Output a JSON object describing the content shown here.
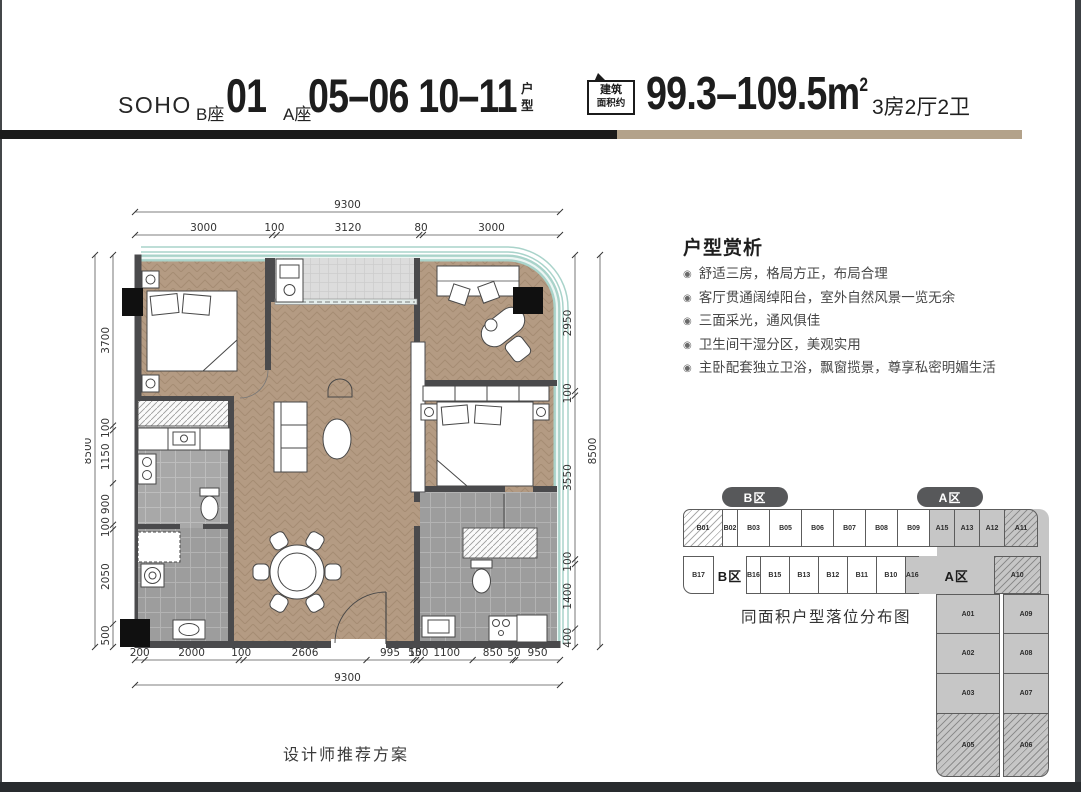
{
  "header": {
    "brand": "SOHO",
    "block_b": "B座",
    "unit_b": "01",
    "block_a": "A座",
    "units_a": "05–06 10–11",
    "suffix_top": "户",
    "suffix_bottom": "型",
    "badge_line1": "建筑",
    "badge_line2": "面积约",
    "area_value": "99.3–109.5m",
    "area_sup": "2",
    "rooms_spec": "3房2厅2卫"
  },
  "colors": {
    "divider_black": "#1b1b1b",
    "divider_tan": "#b3a28a",
    "floor_tan": "#b49b83",
    "glass_teal": "#a9d3ca",
    "wall_dark": "#4a4a4c",
    "zone_gray": "#c6c6c6"
  },
  "floorplan": {
    "dims": {
      "top_overall": "9300",
      "top_segments": [
        "3000",
        "100",
        "3120",
        "80",
        "3000"
      ],
      "left_overall": "8500",
      "left_segments": [
        "3700",
        "100",
        "1150",
        "900",
        "100",
        "2050",
        "500"
      ],
      "right_overall": "8500",
      "right_segments": [
        "2950",
        "100",
        "3550",
        "100",
        "1400",
        "400"
      ],
      "bottom_overall": "9300",
      "bottom_segments": [
        "200",
        "2000",
        "100",
        "2606",
        "995",
        "55",
        "100",
        "1100",
        "850",
        "50",
        "950"
      ]
    },
    "caption": "设计师推荐方案"
  },
  "analysis": {
    "title": "户型赏析",
    "bullet_glyph": "◉",
    "bullets": [
      "舒适三房，格局方正，布局合理",
      "客厅贯通阔绰阳台，室外自然风景一览无余",
      "三面采光，通风俱佳",
      "卫生间干湿分区，美观实用",
      "主卧配套独立卫浴，飘窗揽景，尊享私密明媚生活"
    ]
  },
  "locator": {
    "zone_b": "B区",
    "zone_a": "A区",
    "caption": "同面积户型落位分布图",
    "row1": [
      {
        "id": "B01",
        "zone": "b",
        "w": 40,
        "hatched": true,
        "r": "tl"
      },
      {
        "id": "B02",
        "zone": "b",
        "w": 16
      },
      {
        "id": "B03",
        "zone": "b",
        "w": 33
      },
      {
        "id": "B05",
        "zone": "b",
        "w": 33
      },
      {
        "id": "B06",
        "zone": "b",
        "w": 33
      },
      {
        "id": "B07",
        "zone": "b",
        "w": 33
      },
      {
        "id": "B08",
        "zone": "b",
        "w": 33
      },
      {
        "id": "B09",
        "zone": "b",
        "w": 33
      },
      {
        "id": "A15",
        "zone": "a",
        "w": 26
      },
      {
        "id": "A13",
        "zone": "a",
        "w": 26
      },
      {
        "id": "A12",
        "zone": "a",
        "w": 26
      },
      {
        "id": "A11",
        "zone": "a",
        "w": 34,
        "hatched": true,
        "r": "tr"
      }
    ],
    "row2": [
      {
        "id": "B17",
        "zone": "b",
        "w": 31,
        "r": "bl"
      },
      {
        "label": "B区",
        "zone": "label-b",
        "w": 34
      },
      {
        "id": "B16",
        "zone": "b",
        "w": 13
      },
      {
        "id": "B15",
        "zone": "b",
        "w": 30
      },
      {
        "id": "B13",
        "zone": "b",
        "w": 30
      },
      {
        "id": "B12",
        "zone": "b",
        "w": 30
      },
      {
        "id": "B11",
        "zone": "b",
        "w": 30
      },
      {
        "id": "B10",
        "zone": "b",
        "w": 30
      },
      {
        "id": "A16",
        "zone": "a",
        "w": 14
      },
      {
        "label": "A区",
        "zone": "label-a",
        "w": 76
      },
      {
        "id": "A10",
        "zone": "a",
        "w": 47,
        "hatched": true
      }
    ],
    "tail_left": [
      {
        "id": "A01",
        "h": 40
      },
      {
        "id": "A02",
        "h": 41
      },
      {
        "id": "A03",
        "h": 41
      },
      {
        "id": "A05",
        "h": 64,
        "hatched": true,
        "r": "bl"
      }
    ],
    "tail_right": [
      {
        "id": "A09",
        "h": 40
      },
      {
        "id": "A08",
        "h": 41
      },
      {
        "id": "A07",
        "h": 41
      },
      {
        "id": "A06",
        "h": 64,
        "hatched": true,
        "r": "br"
      }
    ]
  }
}
